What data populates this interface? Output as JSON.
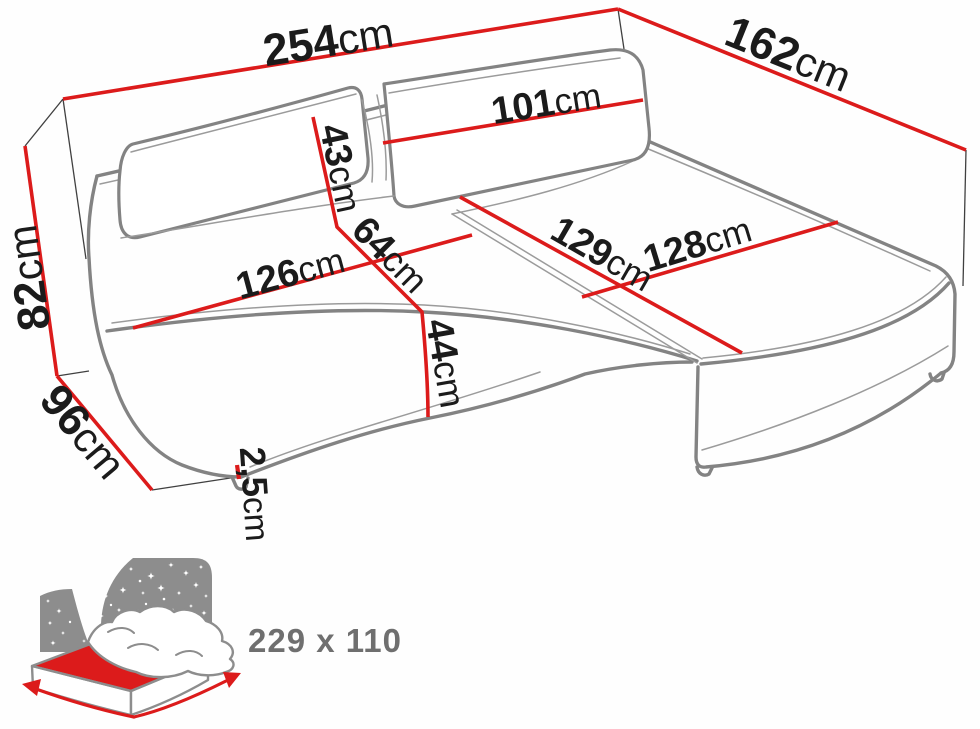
{
  "meta": {
    "description": "Corner sofa (sectional with chaise) dimension diagram with sleeping-function icon",
    "background": "#ffffff"
  },
  "colors": {
    "dimension_line_red": "#dc1b1b",
    "sofa_outline_gray": "#838383",
    "label_text_black": "#1b1b1b",
    "icon_gray": "#8d8d8d",
    "sleeping_size_text_gray": "#6f6f6f"
  },
  "dimensions": {
    "total_width": {
      "value": "254",
      "unit": "cm"
    },
    "chaise_side_depth": {
      "value": "162",
      "unit": "cm"
    },
    "back_height": {
      "value": "82",
      "unit": "cm"
    },
    "side_depth": {
      "value": "96",
      "unit": "cm"
    },
    "backrest_height": {
      "value": "43",
      "unit": "cm"
    },
    "backrest_cushion_width": {
      "value": "101",
      "unit": "cm"
    },
    "seat_width": {
      "value": "126",
      "unit": "cm"
    },
    "seat_depth": {
      "value": "64",
      "unit": "cm"
    },
    "seat_height": {
      "value": "44",
      "unit": "cm"
    },
    "chaise_length": {
      "value": "129",
      "unit": "cm"
    },
    "chaise_width": {
      "value": "128",
      "unit": "cm"
    },
    "leg_height": {
      "value": "2,5",
      "unit": "cm"
    }
  },
  "sleeping_area": {
    "size_label": "229 x 110"
  }
}
